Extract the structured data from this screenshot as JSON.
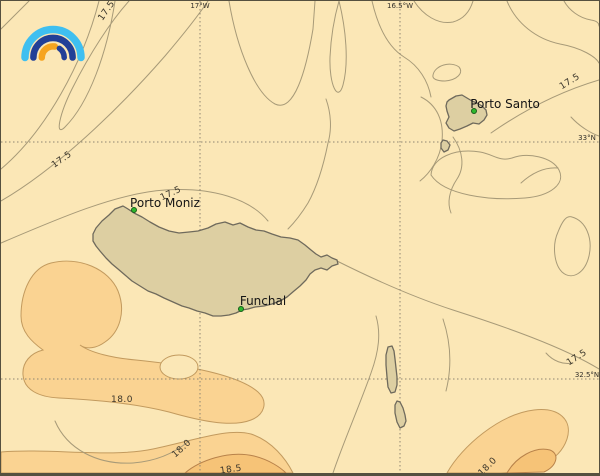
{
  "map": {
    "type": "isotherm-contour-map",
    "region_places": [
      "Porto Santo",
      "Porto Moniz",
      "Funchal"
    ],
    "colors": {
      "background": "#FBE7B6",
      "warm_fill_18": "#FAD392",
      "warmer_fill_18_5": "#F6C377",
      "island_fill": "#DDCFA2",
      "island_stroke": "#6f6a5c",
      "contour_line": "#a79a78",
      "warm_contour_line": "#c29a5e",
      "grid_line": "#8f8672",
      "place_dot": "#2db82d",
      "logo_light_blue": "#3FBFF0",
      "logo_navy": "#223F97",
      "logo_orange": "#F6A41F"
    },
    "grid": {
      "meridians": [
        {
          "label": "17°W",
          "x": 199
        },
        {
          "label": "16.5°W",
          "x": 399
        }
      ],
      "parallels": [
        {
          "label": "33°N",
          "y": 141
        },
        {
          "label": "32.5°N",
          "y": 378
        }
      ]
    },
    "places": [
      {
        "name": "Porto Santo",
        "label_x": 504,
        "label_y": 103,
        "dot_x": 473,
        "dot_y": 110
      },
      {
        "name": "Porto Moniz",
        "label_x": 164,
        "label_y": 202,
        "dot_x": 133,
        "dot_y": 209
      },
      {
        "name": "Funchal",
        "label_x": 262,
        "label_y": 300,
        "dot_x": 240,
        "dot_y": 308
      }
    ],
    "isotherm_values_shown": [
      17.5,
      18.0,
      18.5
    ],
    "contour_labels": [
      {
        "text": "17.5",
        "x": 106,
        "y": 10,
        "rot": -55
      },
      {
        "text": "17.5",
        "x": 61,
        "y": 159,
        "rot": -35
      },
      {
        "text": "17.5",
        "x": 170,
        "y": 193,
        "rot": -25
      },
      {
        "text": "17.5",
        "x": 569,
        "y": 81,
        "rot": -32
      },
      {
        "text": "17.5",
        "x": 576,
        "y": 357,
        "rot": -33
      },
      {
        "text": "18.0",
        "x": 121,
        "y": 399,
        "rot": 0
      },
      {
        "text": "18.0",
        "x": 181,
        "y": 448,
        "rot": -42
      },
      {
        "text": "18.0",
        "x": 487,
        "y": 466,
        "rot": -45
      },
      {
        "text": "18.5",
        "x": 230,
        "y": 469,
        "rot": -8
      }
    ]
  }
}
